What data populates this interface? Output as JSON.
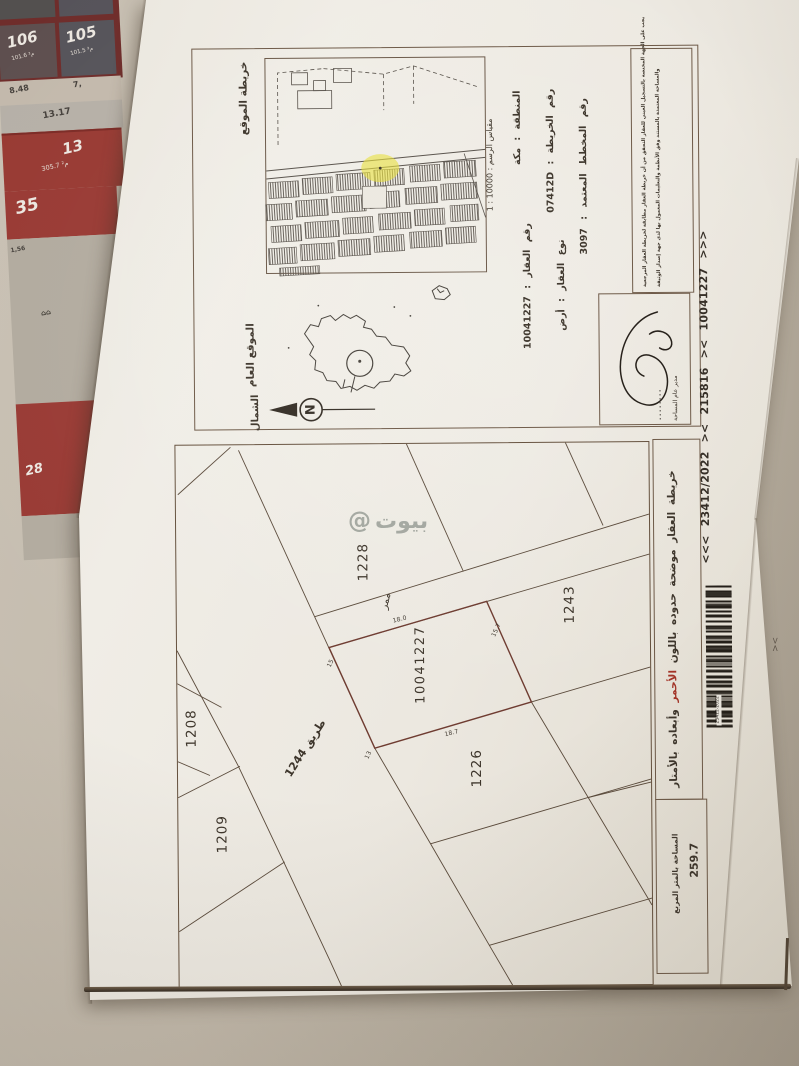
{
  "bg": {
    "tiles": {
      "t106": "106",
      "a106": "101.6 م²",
      "t105": "105",
      "a105": "101.5 م²",
      "d848": "8.48",
      "d7": "7,",
      "d1317": "13.17",
      "t13": "13",
      "a13": "305.7 م²",
      "t35": "35",
      "d156": "1,56",
      "icons": "⌂⌂",
      "t28": "28"
    },
    "stray_mark": "><"
  },
  "watermark": {
    "at": "@",
    "text": "بيوت"
  },
  "doc": {
    "map_title": "خريطة الموقع",
    "scale": "مقياس الرسم : 10000 : 1",
    "info": {
      "region": "المنطقة : مكة",
      "map_no": "رقم الخريطة : 07412D",
      "plan_no": "رقم المخطط المعتمد : 3097",
      "parcel_no": "رقم العقار : 10041227",
      "parcel_type": "نوع العقار : أرض"
    },
    "disclaimer": {
      "line1": "يجب على الجهة المختصة بالتسجيل العيني للعقار التحقق من أن خريطة العقار مطابقة لخريطة العقار المرجعية",
      "line2": "والمساحة المعتمدة بالمستند وفق الأنظمة والتعليمات المعمول بها لدى جهة إصدار الوثيقة"
    },
    "general_location": "الموقع العام",
    "north": "الشمال",
    "north_letter": "N",
    "signature_title": "مدير عام المساحة",
    "ref_line": "<<<   23412/2022   ><   215816   ><   10041227   >>>",
    "barcode_number": "23412-2022",
    "legend": {
      "pre": "خريطة العقار موضحة حدوده باللون ",
      "red": "الأحمر",
      "post": " وأبعاده بالأمتار"
    },
    "area": {
      "label": "المساحة بالمتر المربع",
      "value": "259.7"
    },
    "plan": {
      "p1228": "1228",
      "p1243": "1243",
      "subject": "10041227",
      "p1226": "1226",
      "p1208": "1208",
      "p1209": "1209",
      "road": "طريق 1244",
      "passage": "ممر",
      "dims": {
        "top": "18.0",
        "left": "15",
        "right": "15.7",
        "bottom": "18.7",
        "road_side": "13"
      }
    }
  }
}
